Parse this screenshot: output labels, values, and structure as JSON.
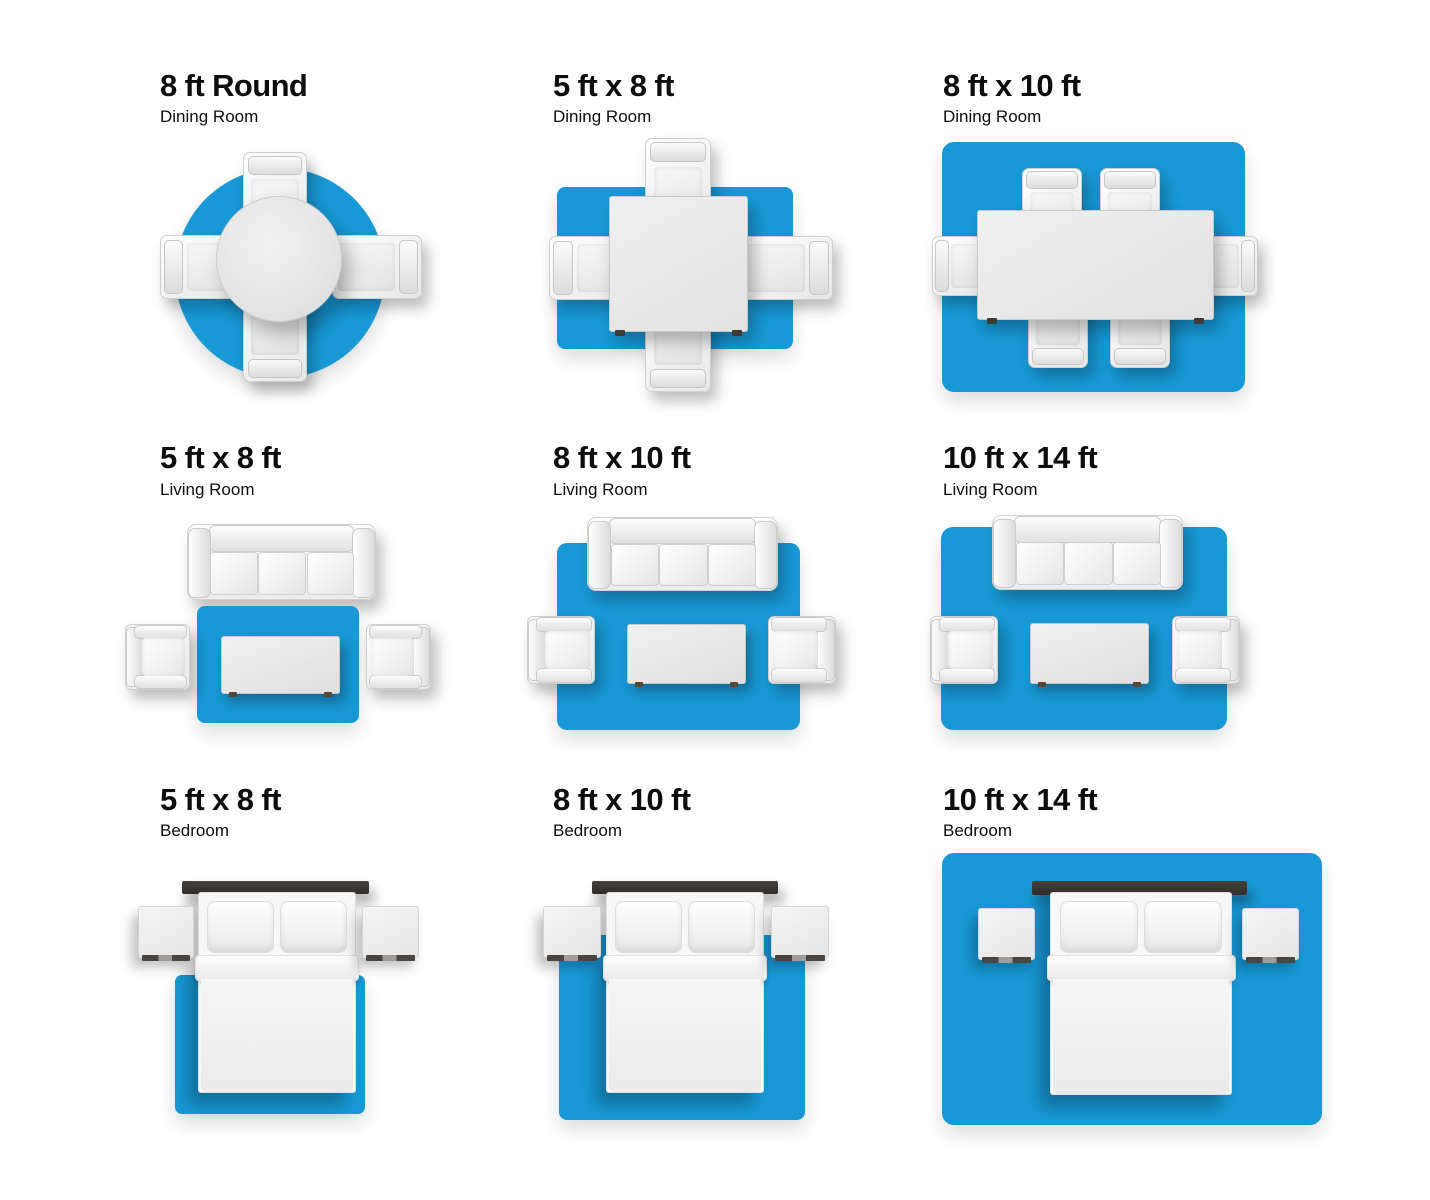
{
  "page": {
    "background": "#ffffff",
    "text_color": "#0d0d0d",
    "accent_blue": "#1899d6"
  },
  "panels": [
    {
      "title": "8 ft Round",
      "subtitle": "Dining Room",
      "rug_shape": "round",
      "furniture": [
        "round-dining-table",
        "4 dining chairs"
      ]
    },
    {
      "title": "5 ft x 8 ft",
      "subtitle": "Dining Room",
      "rug_shape": "rectangle",
      "furniture": [
        "square-dining-table",
        "4 dining chairs"
      ]
    },
    {
      "title": "8 ft x 10 ft",
      "subtitle": "Dining Room",
      "rug_shape": "rectangle",
      "furniture": [
        "long-dining-table",
        "6 dining chairs"
      ]
    },
    {
      "title": "5 ft x 8 ft",
      "subtitle": "Living Room",
      "rug_shape": "rectangle",
      "furniture": [
        "sofa",
        "2 armchairs",
        "coffee-table"
      ]
    },
    {
      "title": "8 ft x 10 ft",
      "subtitle": "Living Room",
      "rug_shape": "rectangle",
      "furniture": [
        "sofa",
        "2 armchairs",
        "coffee-table"
      ]
    },
    {
      "title": "10 ft x 14 ft",
      "subtitle": "Living Room",
      "rug_shape": "rectangle",
      "furniture": [
        "sofa",
        "2 armchairs",
        "coffee-table"
      ]
    },
    {
      "title": "5 ft x 8 ft",
      "subtitle": "Bedroom",
      "rug_shape": "rectangle",
      "furniture": [
        "bed",
        "headboard",
        "2 nightstands"
      ]
    },
    {
      "title": "8 ft x 10 ft",
      "subtitle": "Bedroom",
      "rug_shape": "rectangle",
      "furniture": [
        "bed",
        "headboard",
        "2 nightstands"
      ]
    },
    {
      "title": "10 ft x 14 ft",
      "subtitle": "Bedroom",
      "rug_shape": "rectangle",
      "furniture": [
        "bed",
        "headboard",
        "2 nightstands"
      ]
    }
  ]
}
